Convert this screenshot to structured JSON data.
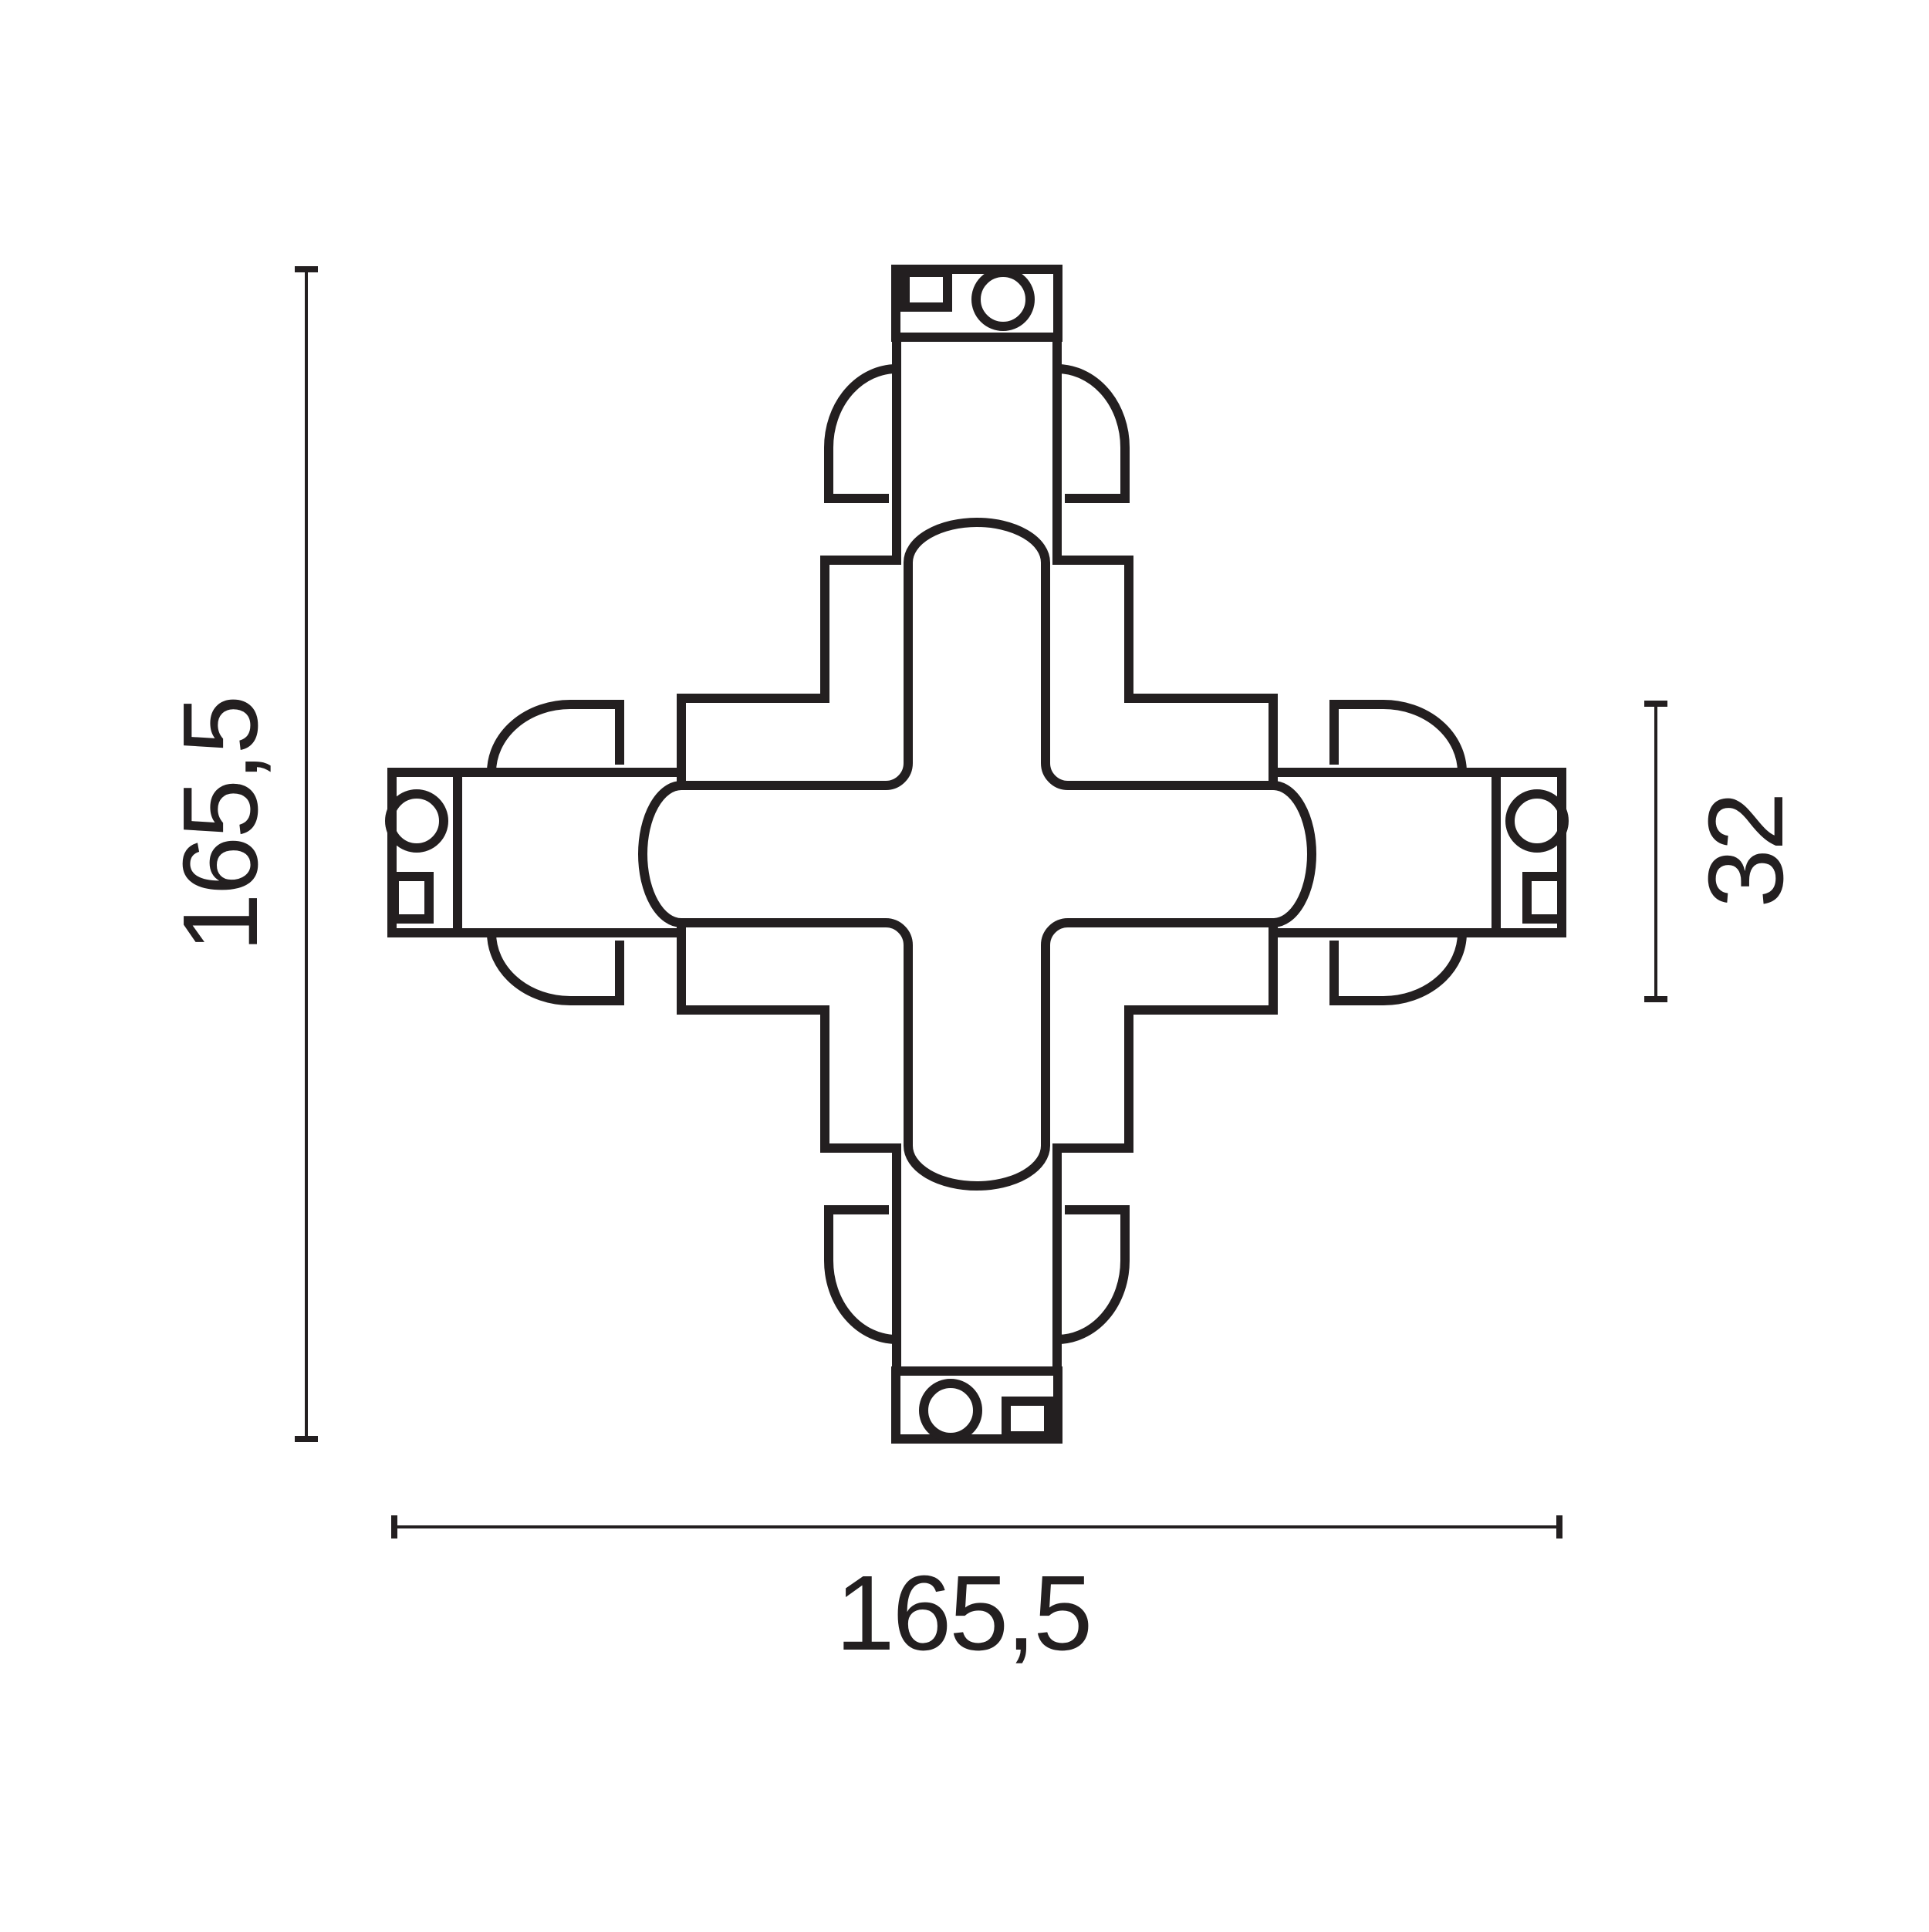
{
  "drawing": {
    "kind": "technical-dimension-drawing",
    "subject": "x-cross-track-connector-top-view",
    "background": "#ffffff",
    "stroke_color": "#231f20"
  },
  "labels": {
    "height": "165,5",
    "width": "165,5",
    "track": "32"
  }
}
